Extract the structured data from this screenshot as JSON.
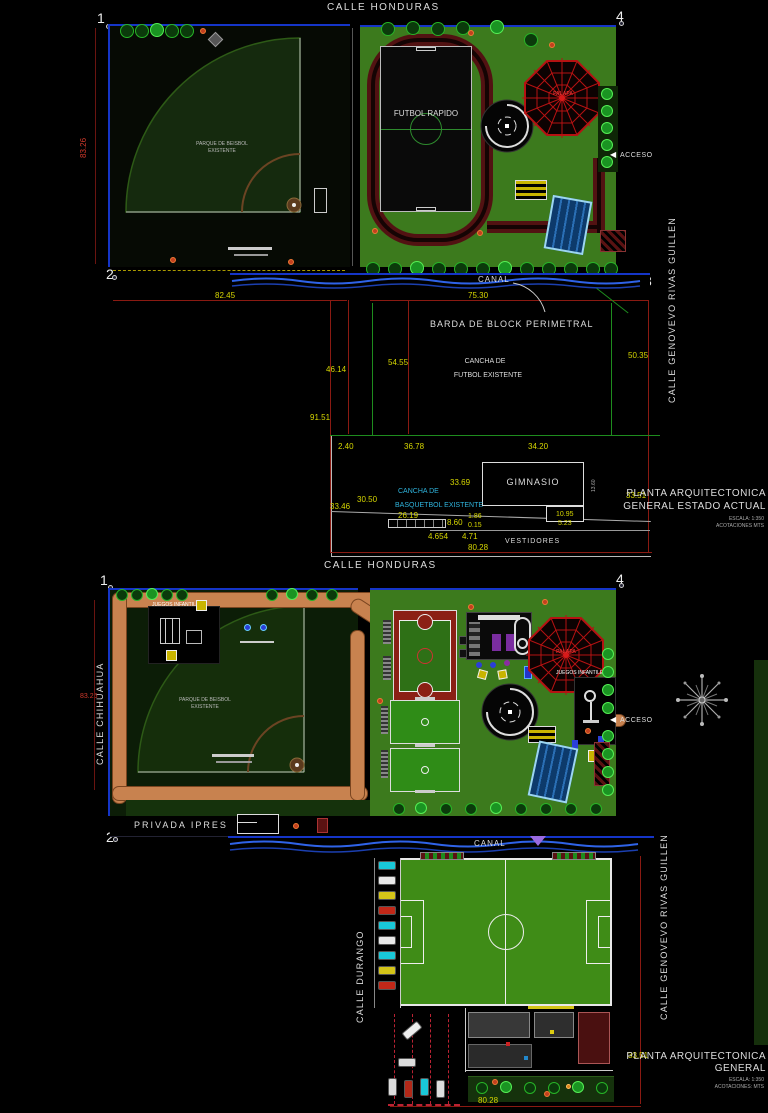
{
  "ex": {
    "street_top": "CALLE HONDURAS",
    "street_right": "CALLE GENOVEVO RIVAS GUILLEN",
    "c1": "1",
    "c2": "2",
    "c3": "3",
    "c4": "4",
    "canal": "CANAL",
    "park1": "PARQUE DE BEISBOL",
    "park2": "EXISTENTE",
    "futbol": "FUTBOL RAPIDO",
    "palapa": "PALAPA",
    "acceso": "ACCESO",
    "arrow": "◀",
    "barda": "BARDA DE BLOCK PERIMETRAL",
    "cf1": "CANCHA DE",
    "cf2": "FUTBOL EXISTENTE",
    "gym": "GIMNASIO",
    "cb1": "CANCHA DE",
    "cb2": "BASQUETBOL EXISTENTE",
    "vest": "VESTIDORES",
    "dims": {
      "h83": "83.26",
      "w82": "82.45",
      "w75": "75.30",
      "h50": "50.35",
      "h46": "46.14",
      "h54": "54.55",
      "h91": "91.51",
      "d240": "2.40",
      "d3678": "36.78",
      "d3420": "34.20",
      "d3369": "33.69",
      "d1360": "13.60",
      "d3050": "30.50",
      "d3346": "33.46",
      "d2619": "26.19",
      "d860": "8.60",
      "d186": "1.86",
      "d015": "0.15",
      "d1095": "10.95",
      "d523": "5.23",
      "d4654": "4.654",
      "d471": "4.71",
      "w80": "80.28",
      "h33": "33.51"
    },
    "tb1": "PLANTA ARQUITECTONICA",
    "tb2": "GENERAL ESTADO ACTUAL",
    "tb_scale": "ESCALA: 1:350",
    "tb_units": "ACOTACIONES MTS"
  },
  "pr": {
    "street_top": "CALLE HONDURAS",
    "street_left": "CALLE CHIHUAHUA",
    "street_right": "CALLE GENOVEVO RIVAS GUILLEN",
    "street_bottom": "CALLE DURANGO",
    "privada": "PRIVADA IPRES",
    "canal": "CANAL",
    "c1": "1",
    "c2": "2",
    "c3": "3",
    "c4": "4",
    "juegos_l": "JUEGOS INFANTILES",
    "juegos_r": "JUEGOS INFANTILES",
    "palapa": "PALAPA",
    "acceso": "ACCESO",
    "arrow": "◀",
    "park1": "PARQUE DE BEISBOL",
    "park2": "EXISTENTE",
    "dims": {
      "h83": "83.26",
      "h33": "33.51",
      "w80": "80.28"
    },
    "tb1": "PLANTA ARQUITECTONICA",
    "tb2": "GENERAL",
    "tb_scale": "ESCALA: 1:350",
    "tb_units": "ACOTACIONES: MTS"
  },
  "colors": {
    "parcel_green": "#3c7a1d",
    "field_green": "#3f8c17",
    "canal_blue": "#2f63e8",
    "track_maroon": "#521212",
    "path_orange": "#c8824f",
    "dim_yellow": "#d6d600",
    "dim_red": "#8a1a12",
    "label_cyan": "#2fb4dd",
    "palapa_red": "#bb1111",
    "pool_blue": "#0d3a6b",
    "boundary_blue": "#1535c8"
  }
}
